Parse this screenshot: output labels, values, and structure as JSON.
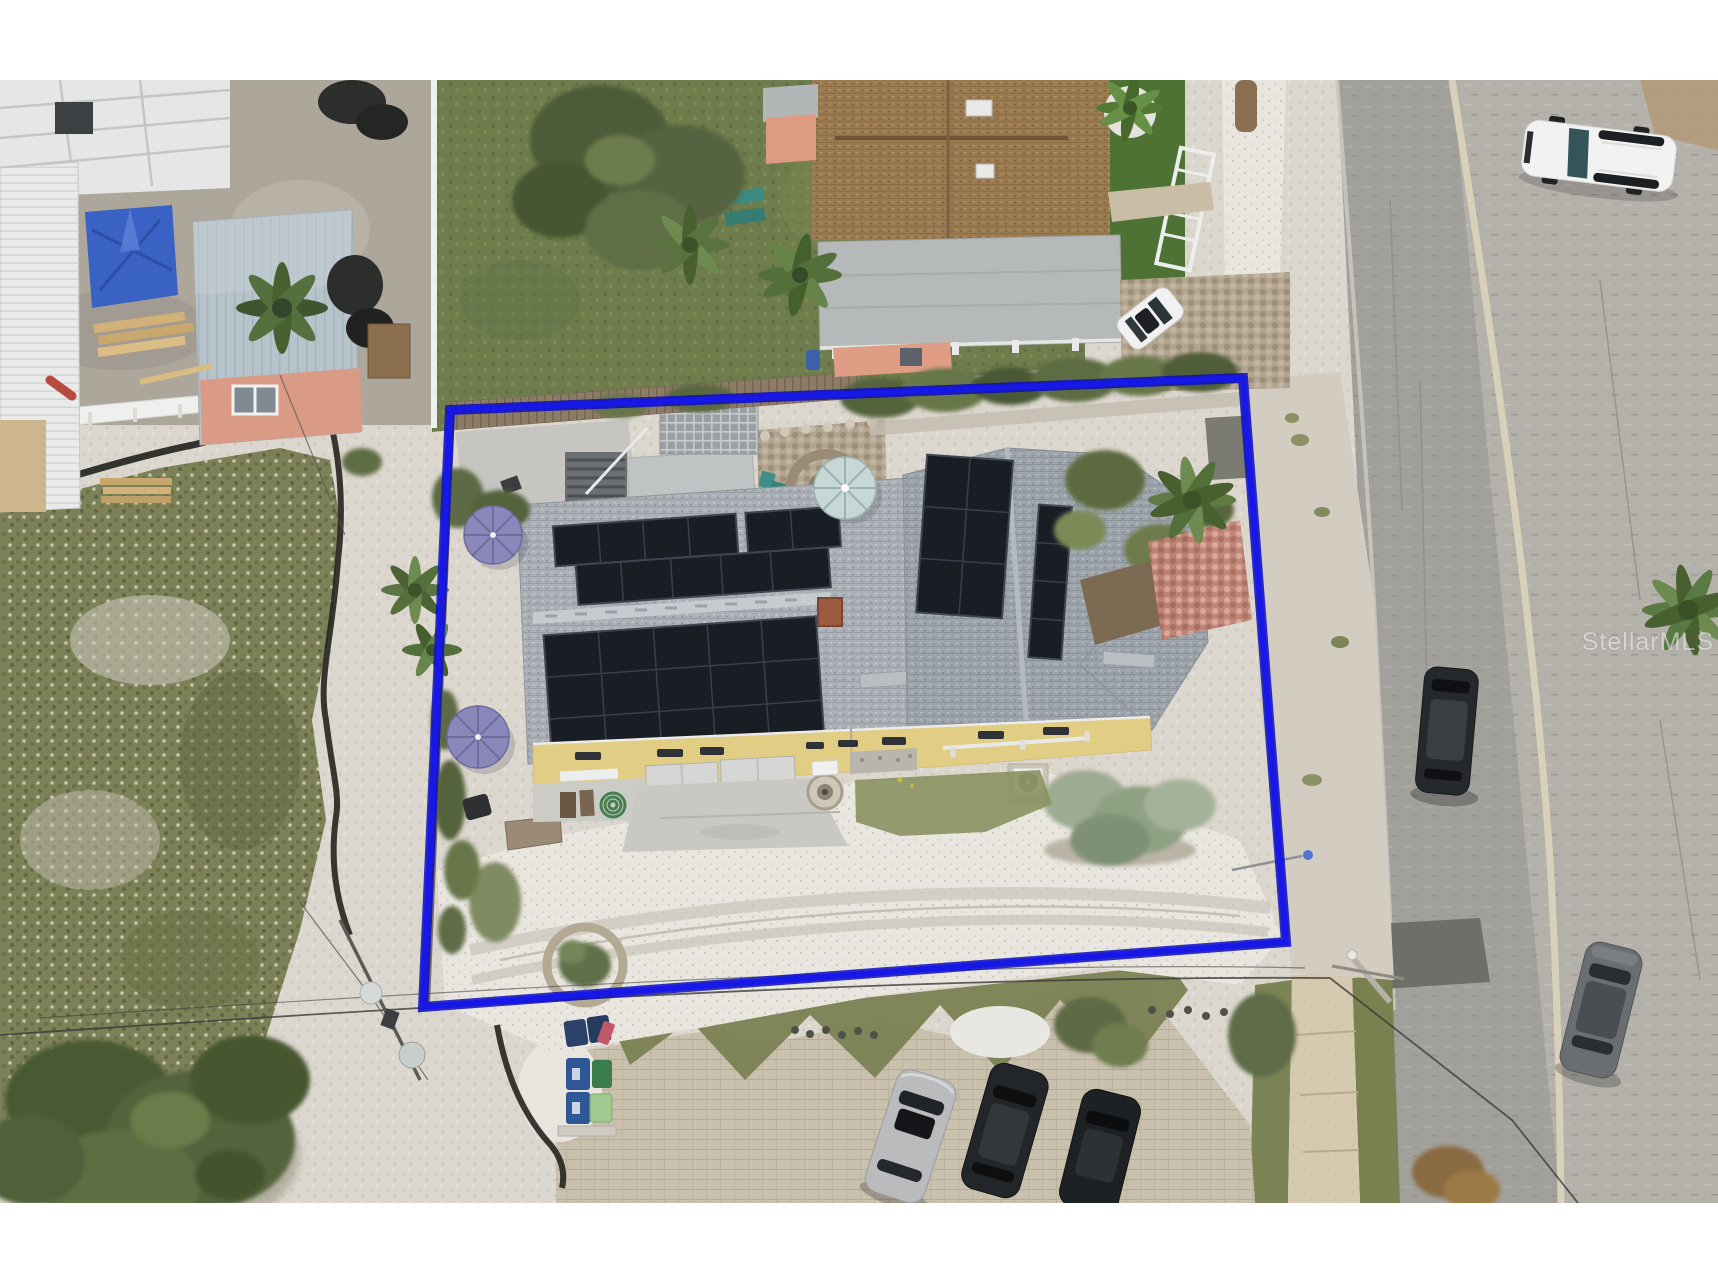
{
  "photo": {
    "kind": "aerial-drone-photo",
    "alt": "Overhead aerial photo of a residential lot outlined in blue: a gray-shingle house covered in rooftop solar panels, purple patio umbrellas, white gravel driveway, wood fences, neighboring homes with brown and metal roofs, a street running down the right side with parked vehicles, a paver parking area with recycle bins at the bottom, and a grassy vacant lot with a large tree at lower left.",
    "watermark": {
      "text": "StellarMLS"
    }
  },
  "colors": {
    "page_background": "#ffffff",
    "boundary": "#1717e8",
    "boundary_dark": "#0d0dbb",
    "solar_panel": "#191d24",
    "west_roof_shingle": "#aab0b5",
    "east_roof_shingle": "#9da4ab",
    "house_wall_yellow": "#e2cd85",
    "garage_door": "#d6d7d4",
    "neighbor_roof_brown": "#9a7a50",
    "neighbor_wall_salmon": "#df9d86",
    "carport_roof": "#b6b9ba",
    "metal_roof_blue": "#b7c3cb",
    "tarp_blue": "#3a62c4",
    "lawn_green": "#6f7d4c",
    "artificial_turf": "#4d7233",
    "field_grass": "#7c8157",
    "sand_ground": "#dcd7ce",
    "white_gravel": "#e9e6df",
    "paver_parking": "#c9c0ae",
    "road_asphalt": "#a2a09b",
    "road_parking_strip": "#b4b1ab",
    "curb_line": "#d8d0b9",
    "sidewalk_tan": "#cdbf9f",
    "umbrella_purple": "#8a87bb",
    "umbrella_pale_blue": "#c5d8d6",
    "white_vehicle": "#f1f2f1",
    "dark_vehicle": "#26292c",
    "silver_vehicle": "#b9bbbd",
    "gray_sedan": "#6a6e71",
    "recycle_bin_blue": "#2f5796",
    "recycle_bin_green": "#3a7d4a"
  },
  "scene": {
    "boundary_points": "450,330 1243,298 1286,862 423,927"
  }
}
